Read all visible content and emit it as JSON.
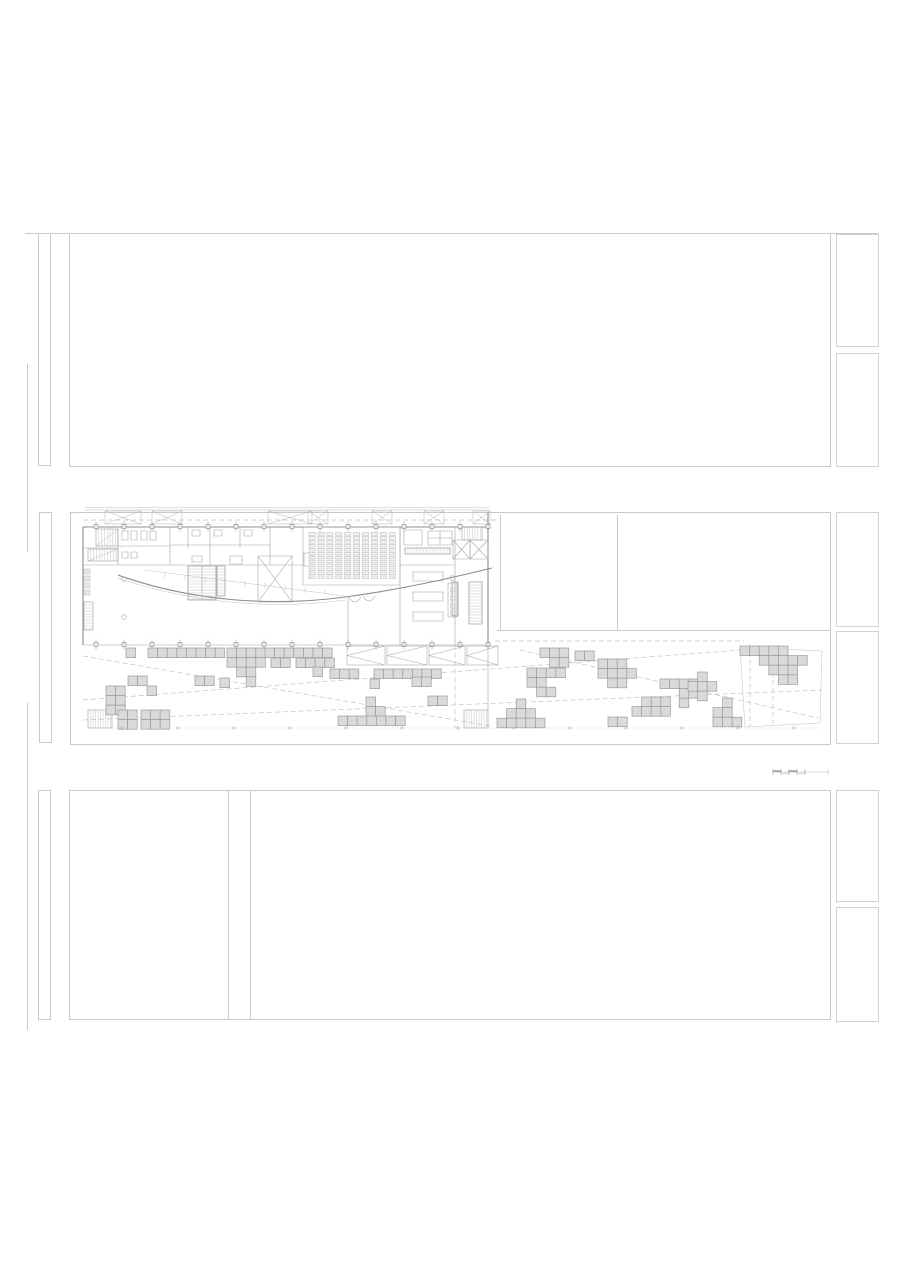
{
  "document": {
    "kind": "architectural floor plan sheet",
    "visible_text": "",
    "background": "#ffffff"
  },
  "colors": {
    "frame": "#c9c9c9",
    "wall": "#8c8c8c",
    "line": "#a6a6a6",
    "faint": "#c4c4c4",
    "square_fill": "#dadada",
    "square_stroke": "#9c9c9c",
    "column_fill": "#ededed",
    "column_stroke": "#8a8a8a"
  },
  "plaza": {
    "unit": 9.6,
    "clusters": [
      {
        "x": 126,
        "y": 648,
        "rows": [
          "1"
        ]
      },
      {
        "x": 148,
        "y": 648,
        "rows": [
          "11111111"
        ]
      },
      {
        "x": 227,
        "y": 648,
        "rows": [
          "1111",
          "1111",
          ".11.",
          "..1."
        ]
      },
      {
        "x": 265,
        "y": 648,
        "rows": [
          "1111111"
        ]
      },
      {
        "x": 271,
        "y": 658,
        "rows": [
          "11"
        ]
      },
      {
        "x": 296,
        "y": 658,
        "rows": [
          "1111"
        ]
      },
      {
        "x": 313,
        "y": 667,
        "rows": [
          "1"
        ]
      },
      {
        "x": 128,
        "y": 676,
        "rows": [
          "11"
        ]
      },
      {
        "x": 147,
        "y": 686,
        "rows": [
          "1"
        ]
      },
      {
        "x": 106,
        "y": 686,
        "rows": [
          "11",
          "11",
          "11"
        ]
      },
      {
        "x": 118,
        "y": 710,
        "rows": [
          "11",
          "11"
        ]
      },
      {
        "x": 141,
        "y": 710,
        "rows": [
          "111",
          "111"
        ]
      },
      {
        "x": 195,
        "y": 676,
        "rows": [
          "11"
        ]
      },
      {
        "x": 220,
        "y": 678,
        "rows": [
          "1"
        ]
      },
      {
        "x": 330,
        "y": 669,
        "rows": [
          "111"
        ]
      },
      {
        "x": 374,
        "y": 669,
        "rows": [
          "1111111"
        ]
      },
      {
        "x": 370,
        "y": 679,
        "rows": [
          "1"
        ]
      },
      {
        "x": 412,
        "y": 677,
        "rows": [
          "11"
        ]
      },
      {
        "x": 428,
        "y": 696,
        "rows": [
          "11"
        ]
      },
      {
        "x": 366,
        "y": 697,
        "rows": [
          "1.",
          "11"
        ]
      },
      {
        "x": 338,
        "y": 716,
        "rows": [
          "1111111"
        ]
      },
      {
        "x": 527,
        "y": 668,
        "rows": [
          "1111",
          "11..",
          ".11."
        ]
      },
      {
        "x": 497,
        "y": 699,
        "rows": [
          "..1..",
          ".111.",
          "11111"
        ]
      },
      {
        "x": 540,
        "y": 648,
        "rows": [
          "111",
          ".11"
        ]
      },
      {
        "x": 575,
        "y": 651,
        "rows": [
          "11"
        ]
      },
      {
        "x": 598,
        "y": 659,
        "rows": [
          "111..",
          "1111.",
          ".11.."
        ]
      },
      {
        "x": 660,
        "y": 679,
        "rows": [
          "1111",
          "..11",
          "..1."
        ]
      },
      {
        "x": 632,
        "y": 697,
        "rows": [
          ".111",
          "1111"
        ]
      },
      {
        "x": 608,
        "y": 717,
        "rows": [
          "11"
        ]
      },
      {
        "x": 688,
        "y": 672,
        "rows": [
          ".1.",
          "111",
          ".1."
        ]
      },
      {
        "x": 713,
        "y": 698,
        "rows": [
          ".1.",
          "11.",
          "111"
        ]
      },
      {
        "x": 740,
        "y": 646,
        "rows": [
          "11111..",
          "..11111",
          "...111.",
          "....11."
        ]
      }
    ],
    "canopy_triangles": [
      {
        "x": 347,
        "y": 646,
        "w": 38,
        "h": 19
      },
      {
        "x": 387,
        "y": 646,
        "w": 40,
        "h": 19
      },
      {
        "x": 429,
        "y": 646,
        "w": 36,
        "h": 19
      },
      {
        "x": 467,
        "y": 646,
        "w": 31,
        "h": 19
      }
    ],
    "bottom_tick_xs": [
      122,
      178,
      234,
      290,
      346,
      402,
      458,
      514,
      570,
      626,
      682,
      738,
      794
    ],
    "bottom_tick_y": 728
  },
  "building": {
    "columns": {
      "x_start": 96,
      "spacing": 28,
      "count": 15,
      "size": 4,
      "y_top": 524.5,
      "y_bottom": 642.5
    },
    "auditorium_seats": {
      "cols": 10,
      "x0": 309,
      "col_pitch": 8.9,
      "seat_w": 6.2,
      "rows": 12,
      "y0": 532.5,
      "row_pitch": 3.95,
      "seat_h": 2.7
    },
    "roof_monitors": [
      {
        "x": 105,
        "w": 36
      },
      {
        "x": 152,
        "w": 30
      },
      {
        "x": 268,
        "w": 44
      },
      {
        "x": 308,
        "w": 20
      },
      {
        "x": 372,
        "w": 20
      },
      {
        "x": 424,
        "w": 20
      },
      {
        "x": 473,
        "w": 17
      }
    ],
    "roof_monitor_y": 511,
    "roof_monitor_h": 13,
    "stairs": [
      {
        "x": 96,
        "y": 529,
        "w": 22,
        "h": 17,
        "dir": "v",
        "step": 2.8
      },
      {
        "x": 88,
        "y": 549,
        "w": 30,
        "h": 12,
        "dir": "v",
        "step": 2.8
      },
      {
        "x": 188,
        "y": 566,
        "w": 28,
        "h": 34,
        "dir": "h",
        "step": 3
      },
      {
        "x": 217,
        "y": 566,
        "w": 8,
        "h": 30,
        "dir": "h",
        "step": 3
      },
      {
        "x": 84,
        "y": 602,
        "w": 9,
        "h": 28,
        "dir": "h",
        "step": 3
      },
      {
        "x": 469,
        "y": 582,
        "w": 13,
        "h": 42,
        "dir": "h",
        "step": 3
      },
      {
        "x": 452,
        "y": 582,
        "w": 6,
        "h": 34,
        "dir": "h",
        "step": 3
      },
      {
        "x": 462,
        "y": 527,
        "w": 20,
        "h": 13,
        "dir": "v",
        "step": 2.6
      },
      {
        "x": 88,
        "y": 710,
        "w": 24,
        "h": 18,
        "dir": "v",
        "step": 2.5
      },
      {
        "x": 464,
        "y": 710,
        "w": 24,
        "h": 18,
        "dir": "v",
        "step": 2.5
      },
      {
        "x": 405,
        "y": 548,
        "w": 45,
        "h": 6,
        "dir": "v",
        "step": 3
      }
    ]
  },
  "scalebar": {
    "x": 772,
    "y": 764,
    "w": 58,
    "h": 12,
    "segments": 4,
    "seg_w": 8
  }
}
